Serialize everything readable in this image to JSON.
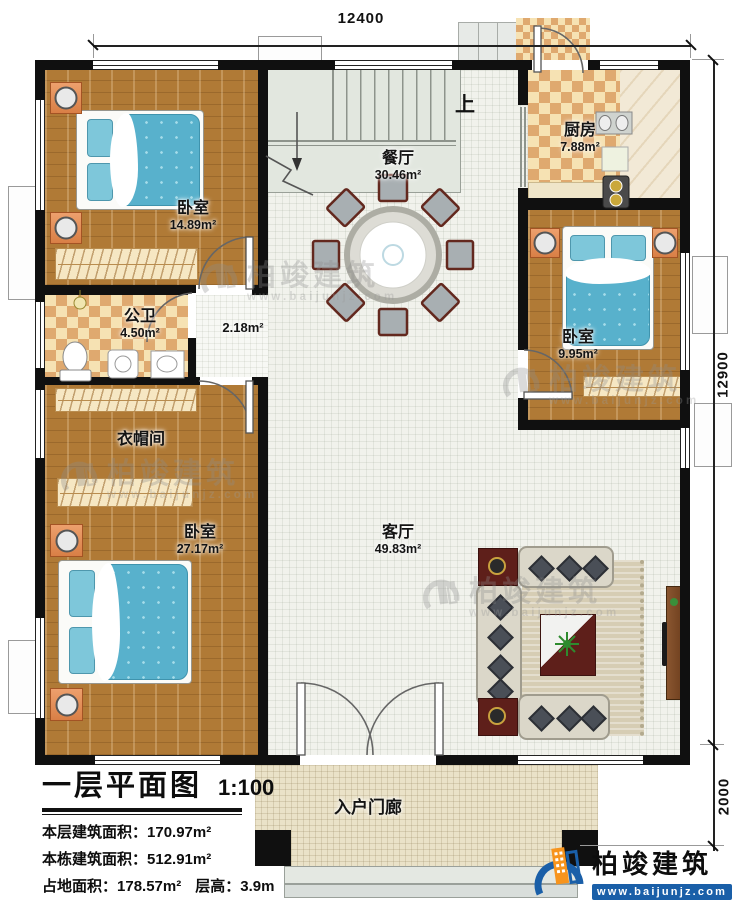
{
  "dimensions": {
    "top": "12400",
    "right_upper": "12900",
    "right_lower": "2000"
  },
  "rooms": {
    "bedroom_tl": {
      "name": "卧室",
      "area": "14.89m²"
    },
    "dining": {
      "name": "餐厅",
      "area": "30.46m²"
    },
    "kitchen": {
      "name": "厨房",
      "area": "7.88m²"
    },
    "bathroom": {
      "name": "公卫",
      "area": "4.50m²"
    },
    "hallway": {
      "area": "2.18m²"
    },
    "bedroom_r": {
      "name": "卧室",
      "area": "9.95m²"
    },
    "cloakroom": {
      "name": "衣帽间"
    },
    "bedroom_bl": {
      "name": "卧室",
      "area": "27.17m²"
    },
    "living": {
      "name": "客厅",
      "area": "49.83m²"
    },
    "porch": {
      "name": "入户门廊"
    },
    "stair_direction": "上"
  },
  "title_block": {
    "title": "一层平面图",
    "scale": "1:100",
    "rows": [
      {
        "label": "本层建筑面积：",
        "value": "170.97m²"
      },
      {
        "label": "本栋建筑面积：",
        "value": "512.91m²"
      },
      {
        "label": "占地面积：",
        "value": "178.57m²",
        "label2": "层高：",
        "value2": "3.9m"
      }
    ]
  },
  "branding": {
    "company": "柏竣建筑",
    "website": "www.baijunjz.com"
  }
}
